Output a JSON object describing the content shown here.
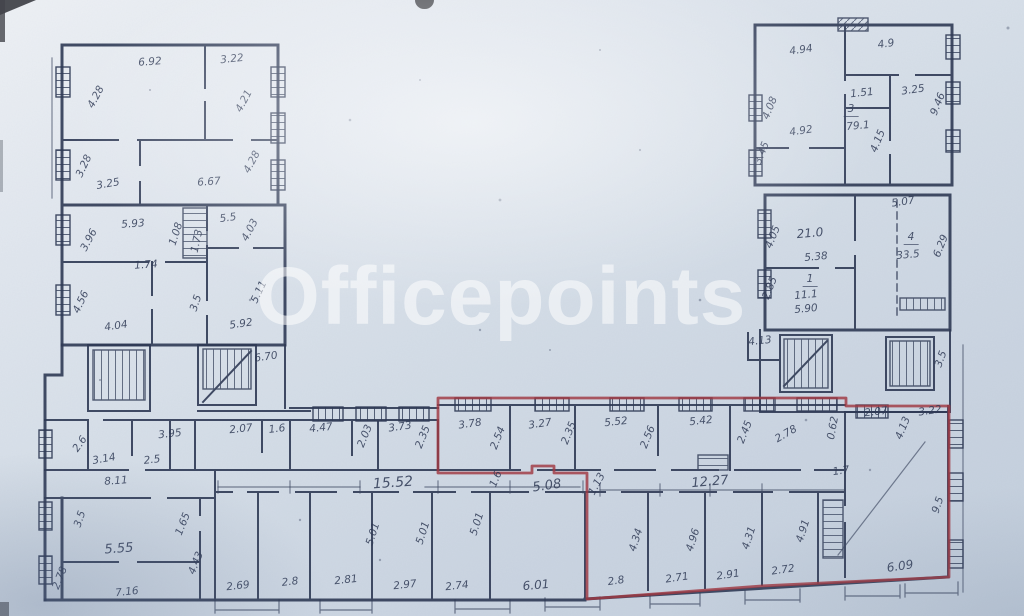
{
  "watermark": {
    "text": "Officepoints"
  },
  "colors": {
    "paper_light": "#eef1f5",
    "paper_dark": "#c2cedc",
    "ink": "#2f3a55",
    "outline_red": "#a03842",
    "watermark": "#ffffff"
  },
  "labels": [
    {
      "t": "6.92",
      "x": 150,
      "y": 62,
      "r": -4
    },
    {
      "t": "3.22",
      "x": 232,
      "y": 59,
      "r": -6
    },
    {
      "t": "4.28",
      "x": 96,
      "y": 97,
      "r": -62
    },
    {
      "t": "4.21",
      "x": 244,
      "y": 101,
      "r": -62
    },
    {
      "t": "3.28",
      "x": 84,
      "y": 166,
      "r": -65
    },
    {
      "t": "3.25",
      "x": 108,
      "y": 184,
      "r": -10
    },
    {
      "t": "6.67",
      "x": 209,
      "y": 182,
      "r": -4
    },
    {
      "t": "4.28",
      "x": 252,
      "y": 162,
      "r": -62
    },
    {
      "t": "5.93",
      "x": 133,
      "y": 224,
      "r": -4
    },
    {
      "t": "3.96",
      "x": 89,
      "y": 240,
      "r": -62
    },
    {
      "t": "1.08",
      "x": 176,
      "y": 234,
      "r": -72
    },
    {
      "t": "1.73",
      "x": 197,
      "y": 241,
      "r": -78
    },
    {
      "t": "5.5",
      "x": 228,
      "y": 218,
      "r": -8
    },
    {
      "t": "4.03",
      "x": 250,
      "y": 230,
      "r": -62
    },
    {
      "t": "1.74",
      "x": 146,
      "y": 265,
      "r": -4
    },
    {
      "t": "4.56",
      "x": 81,
      "y": 302,
      "r": -65
    },
    {
      "t": "4.04",
      "x": 116,
      "y": 326,
      "r": -8
    },
    {
      "t": "3.5",
      "x": 196,
      "y": 303,
      "r": -72
    },
    {
      "t": "5.92",
      "x": 241,
      "y": 324,
      "r": -8
    },
    {
      "t": "5.11",
      "x": 259,
      "y": 292,
      "r": -65
    },
    {
      "t": "6.70",
      "x": 266,
      "y": 357,
      "r": -8
    },
    {
      "t": "4.13",
      "x": 760,
      "y": 341,
      "r": -6
    },
    {
      "t": "3.5",
      "x": 941,
      "y": 359,
      "r": -70
    },
    {
      "t": "3.95",
      "x": 170,
      "y": 434,
      "r": -6
    },
    {
      "t": "2.6",
      "x": 80,
      "y": 444,
      "r": -55
    },
    {
      "t": "3.14",
      "x": 104,
      "y": 459,
      "r": -10
    },
    {
      "t": "2.5",
      "x": 152,
      "y": 460,
      "r": -6
    },
    {
      "t": "2.07",
      "x": 241,
      "y": 429,
      "r": -6
    },
    {
      "t": "1.6",
      "x": 277,
      "y": 429,
      "r": -6
    },
    {
      "t": "4.47",
      "x": 321,
      "y": 428,
      "r": -6
    },
    {
      "t": "2.03",
      "x": 365,
      "y": 436,
      "r": -68
    },
    {
      "t": "3.73",
      "x": 400,
      "y": 427,
      "r": -8
    },
    {
      "t": "2.35",
      "x": 423,
      "y": 437,
      "r": -68
    },
    {
      "t": "3.78",
      "x": 470,
      "y": 424,
      "r": -8
    },
    {
      "t": "2.54",
      "x": 498,
      "y": 438,
      "r": -68
    },
    {
      "t": "3.27",
      "x": 540,
      "y": 424,
      "r": -8
    },
    {
      "t": "2.35",
      "x": 569,
      "y": 433,
      "r": -68
    },
    {
      "t": "5.52",
      "x": 616,
      "y": 422,
      "r": -6
    },
    {
      "t": "2.56",
      "x": 648,
      "y": 437,
      "r": -68
    },
    {
      "t": "5.42",
      "x": 701,
      "y": 421,
      "r": -6
    },
    {
      "t": "2.45",
      "x": 745,
      "y": 432,
      "r": -68
    },
    {
      "t": "2.78",
      "x": 786,
      "y": 434,
      "r": -30
    },
    {
      "t": "0.62",
      "x": 833,
      "y": 428,
      "r": -80
    },
    {
      "t": "2.07",
      "x": 876,
      "y": 412,
      "r": -6
    },
    {
      "t": "4.13",
      "x": 903,
      "y": 428,
      "r": -68
    },
    {
      "t": "3.22",
      "x": 930,
      "y": 411,
      "r": -8
    },
    {
      "t": "15.52",
      "x": 393,
      "y": 483,
      "r": -4,
      "s": 14
    },
    {
      "t": "1.6",
      "x": 496,
      "y": 479,
      "r": -68
    },
    {
      "t": "5.08",
      "x": 547,
      "y": 486,
      "r": -8,
      "s": 13
    },
    {
      "t": "1.13",
      "x": 597,
      "y": 484,
      "r": -62
    },
    {
      "t": "12.27",
      "x": 710,
      "y": 482,
      "r": -5,
      "s": 13
    },
    {
      "t": "1.7",
      "x": 841,
      "y": 471,
      "r": -8
    },
    {
      "t": "8.11",
      "x": 116,
      "y": 481,
      "r": -4
    },
    {
      "t": "3.5",
      "x": 80,
      "y": 519,
      "r": -72
    },
    {
      "t": "5.55",
      "x": 119,
      "y": 549,
      "r": -4,
      "s": 13
    },
    {
      "t": "2.78",
      "x": 60,
      "y": 578,
      "r": -68
    },
    {
      "t": "7.16",
      "x": 127,
      "y": 592,
      "r": -6
    },
    {
      "t": "1.65",
      "x": 183,
      "y": 524,
      "r": -68
    },
    {
      "t": "4.43",
      "x": 196,
      "y": 563,
      "r": -68
    },
    {
      "t": "2.69",
      "x": 238,
      "y": 586,
      "r": -6
    },
    {
      "t": "2.8",
      "x": 290,
      "y": 582,
      "r": -6
    },
    {
      "t": "2.81",
      "x": 346,
      "y": 580,
      "r": -6
    },
    {
      "t": "5.01",
      "x": 373,
      "y": 534,
      "r": -72
    },
    {
      "t": "5.01",
      "x": 423,
      "y": 533,
      "r": -72
    },
    {
      "t": "2.97",
      "x": 405,
      "y": 585,
      "r": -6
    },
    {
      "t": "2.74",
      "x": 457,
      "y": 586,
      "r": -6
    },
    {
      "t": "5.01",
      "x": 477,
      "y": 524,
      "r": -72
    },
    {
      "t": "6.01",
      "x": 536,
      "y": 585,
      "r": -5,
      "s": 12
    },
    {
      "t": "4.34",
      "x": 636,
      "y": 540,
      "r": -72
    },
    {
      "t": "4.96",
      "x": 693,
      "y": 540,
      "r": -72
    },
    {
      "t": "4.31",
      "x": 749,
      "y": 538,
      "r": -72
    },
    {
      "t": "4.91",
      "x": 803,
      "y": 531,
      "r": -72
    },
    {
      "t": "2.8",
      "x": 616,
      "y": 581,
      "r": -8
    },
    {
      "t": "2.71",
      "x": 677,
      "y": 578,
      "r": -8
    },
    {
      "t": "2.91",
      "x": 728,
      "y": 575,
      "r": -8
    },
    {
      "t": "2.72",
      "x": 783,
      "y": 570,
      "r": -8
    },
    {
      "t": "6.09",
      "x": 900,
      "y": 566,
      "r": -8,
      "s": 12
    },
    {
      "t": "9.5",
      "x": 938,
      "y": 505,
      "r": -72
    },
    {
      "t": "4.94",
      "x": 801,
      "y": 50,
      "r": -8
    },
    {
      "t": "4.9",
      "x": 886,
      "y": 44,
      "r": -8
    },
    {
      "t": "9.46",
      "x": 938,
      "y": 104,
      "r": -68
    },
    {
      "t": "4.08",
      "x": 770,
      "y": 108,
      "r": -68
    },
    {
      "t": "4.92",
      "x": 801,
      "y": 131,
      "r": -8
    },
    {
      "t": "1.51",
      "x": 862,
      "y": 93,
      "r": -6
    },
    {
      "t": "3",
      "x": 851,
      "y": 110,
      "r": 0,
      "u": true
    },
    {
      "t": "79.1",
      "x": 858,
      "y": 126,
      "r": -5
    },
    {
      "t": "3.25",
      "x": 913,
      "y": 90,
      "r": -8
    },
    {
      "t": "4.15",
      "x": 878,
      "y": 141,
      "r": -68
    },
    {
      "t": "3.45",
      "x": 762,
      "y": 153,
      "r": -68
    },
    {
      "t": "21.0",
      "x": 810,
      "y": 233,
      "r": -5,
      "s": 12
    },
    {
      "t": "5.38",
      "x": 816,
      "y": 257,
      "r": -5
    },
    {
      "t": "5.07",
      "x": 903,
      "y": 202,
      "r": -8
    },
    {
      "t": "4",
      "x": 911,
      "y": 238,
      "r": 0,
      "u": true
    },
    {
      "t": "33.5",
      "x": 908,
      "y": 255,
      "r": -5
    },
    {
      "t": "6.29",
      "x": 941,
      "y": 246,
      "r": -68
    },
    {
      "t": "4.05",
      "x": 773,
      "y": 237,
      "r": -68
    },
    {
      "t": "2.85",
      "x": 770,
      "y": 288,
      "r": -68
    },
    {
      "t": "1",
      "x": 810,
      "y": 280,
      "r": 0,
      "u": true
    },
    {
      "t": "11.1",
      "x": 806,
      "y": 295,
      "r": -5
    },
    {
      "t": "5.90",
      "x": 806,
      "y": 309,
      "r": -5
    }
  ]
}
